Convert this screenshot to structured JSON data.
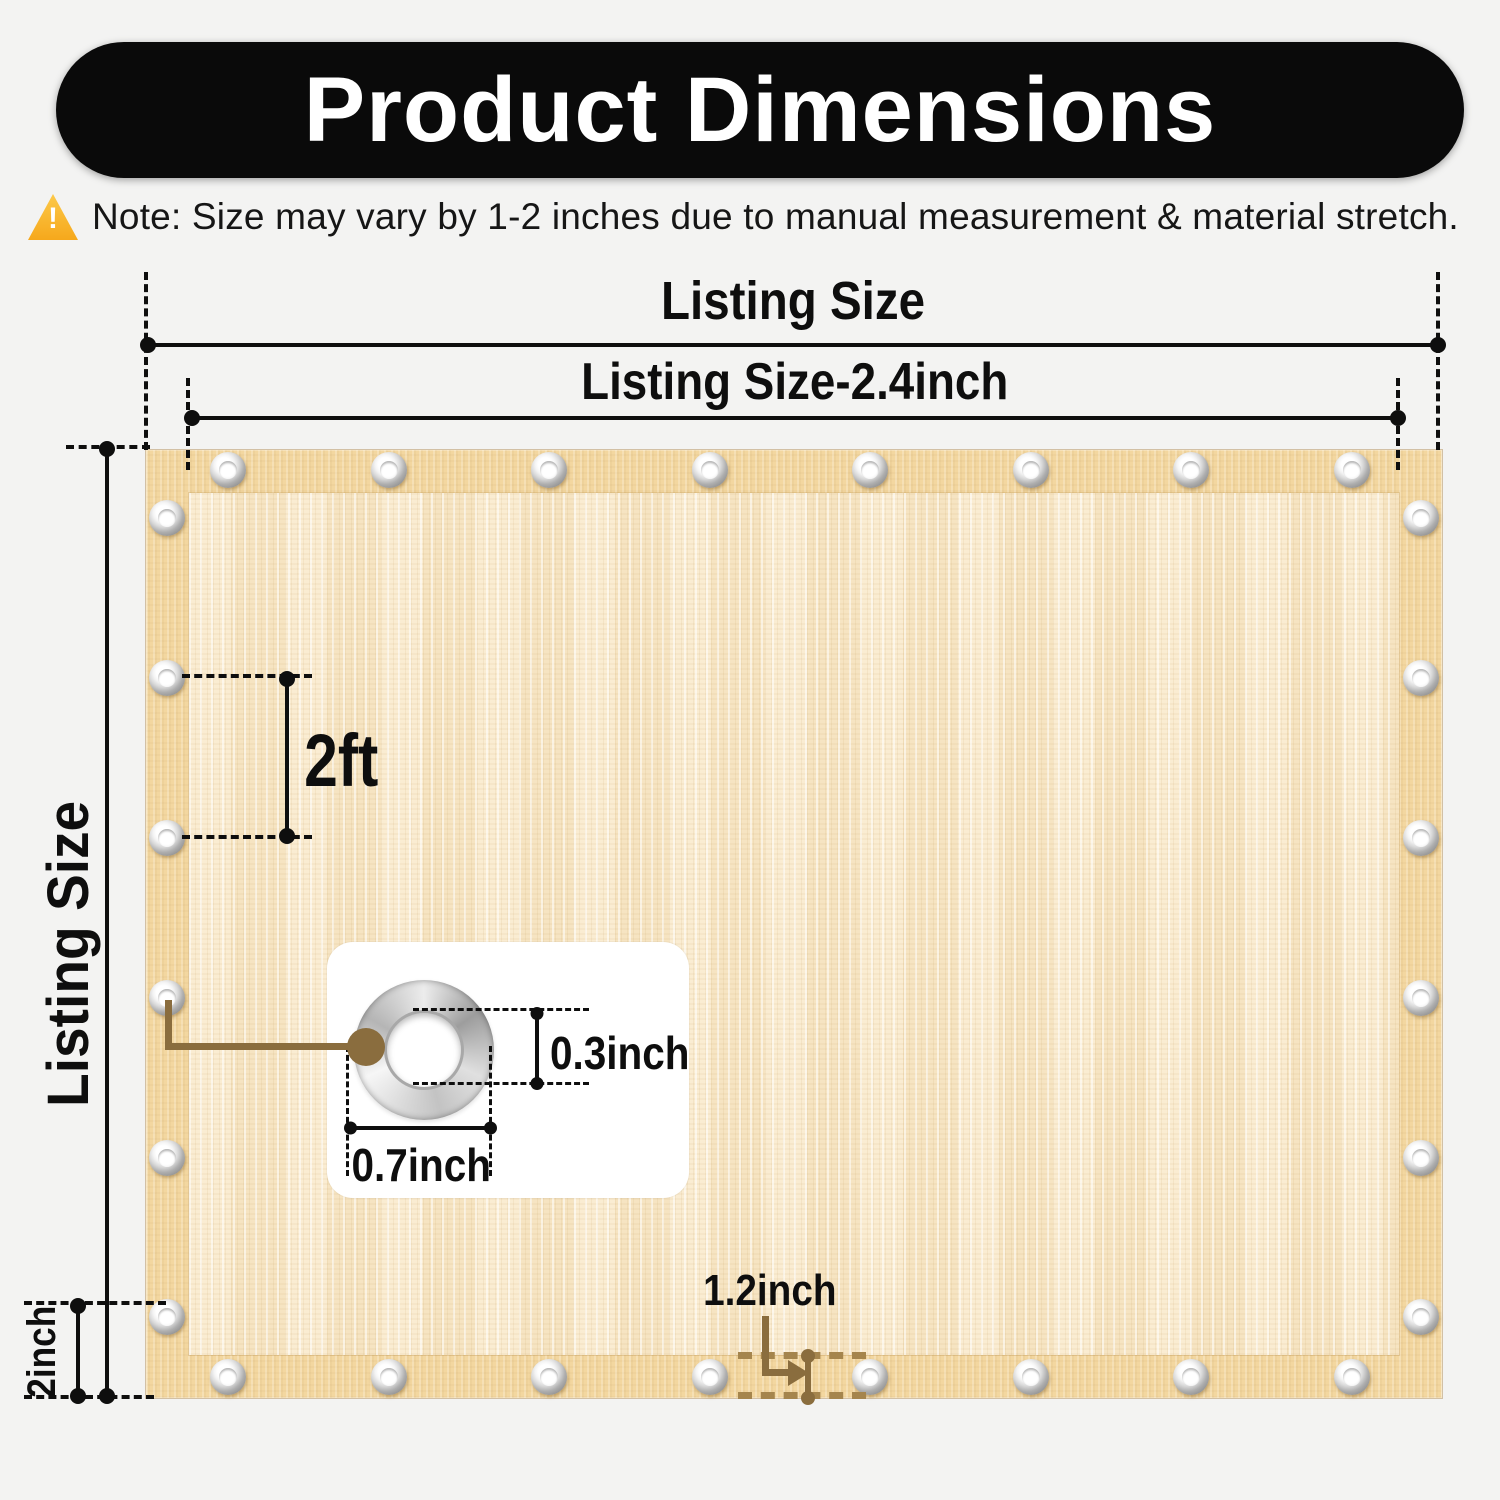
{
  "header": {
    "title": "Product Dimensions"
  },
  "note": {
    "icon": "warning-triangle-icon",
    "text": "Note: Size may vary by 1-2 inches due to manual measurement & material stretch."
  },
  "labels": {
    "listing_width": "Listing Size",
    "listing_width_inner": "Listing Size-2.4inch",
    "listing_height": "Listing Size",
    "grommet_spacing": "2ft",
    "grommet_inner_diameter": "0.3inch",
    "grommet_outer_diameter": "0.7inch",
    "hem_height": "2inch",
    "hem_width": "1.2inch"
  },
  "tarp": {
    "grommets": {
      "top": 8,
      "bottom": 8,
      "left": 6,
      "right": 6
    }
  },
  "colors": {
    "banner_black": "#0a0a0a",
    "fabric_hem": "#f3d7a0",
    "fabric_inner": "#f9e8c7",
    "annotation_brown": "#8a6d3e",
    "annotation_brown_light": "#a5854d",
    "warning_orange": "#f6a81c"
  }
}
